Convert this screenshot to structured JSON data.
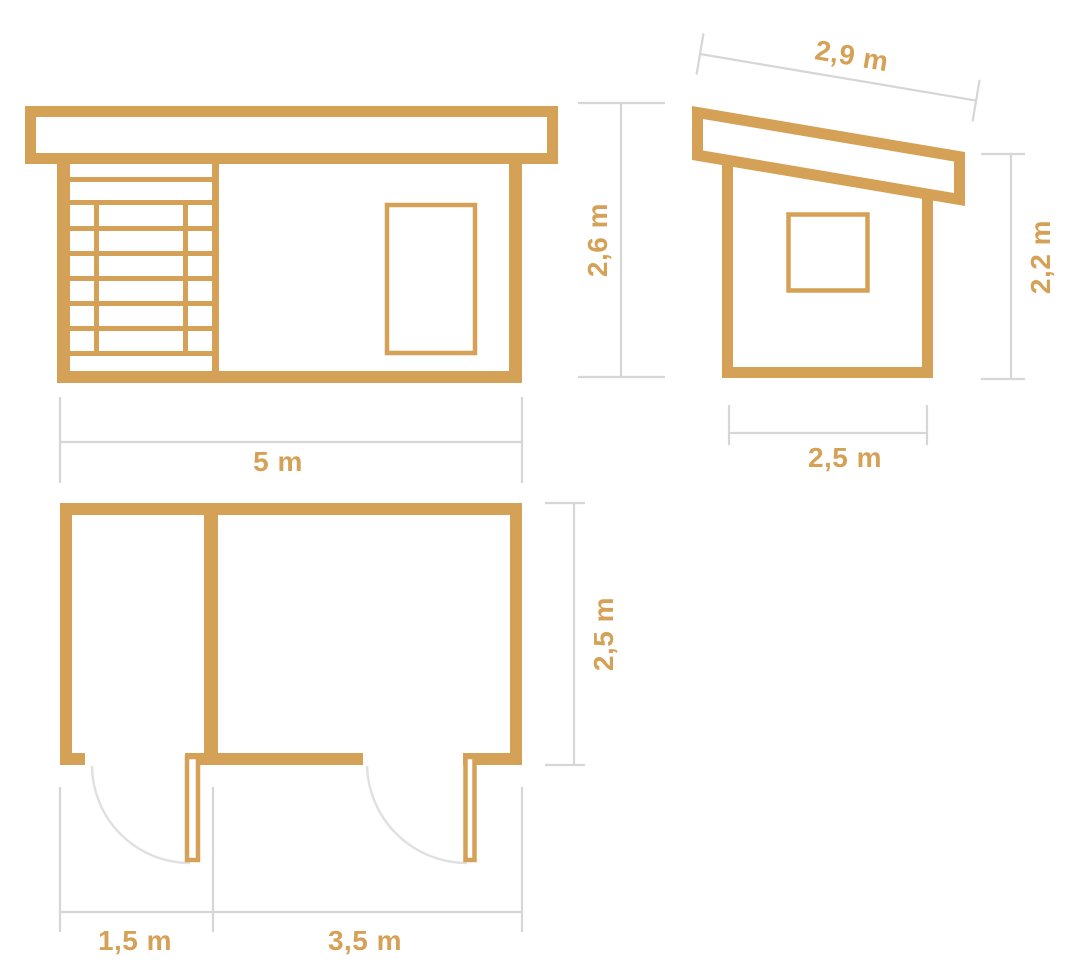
{
  "colors": {
    "wood": "#D5A157",
    "dimension_line": "#D6D6D6",
    "door_swing": "#E0E0E0",
    "background": "#FFFFFF"
  },
  "views": {
    "front_elevation": {
      "width_label": "5 m",
      "height_label": "2,6 m"
    },
    "side_elevation": {
      "roof_width_label": "2,9 m",
      "wall_height_label": "2,2 m",
      "depth_label": "2,5 m"
    },
    "floor_plan": {
      "depth_label": "2,5 m",
      "room1_width_label": "1,5 m",
      "room2_width_label": "3,5 m"
    }
  }
}
